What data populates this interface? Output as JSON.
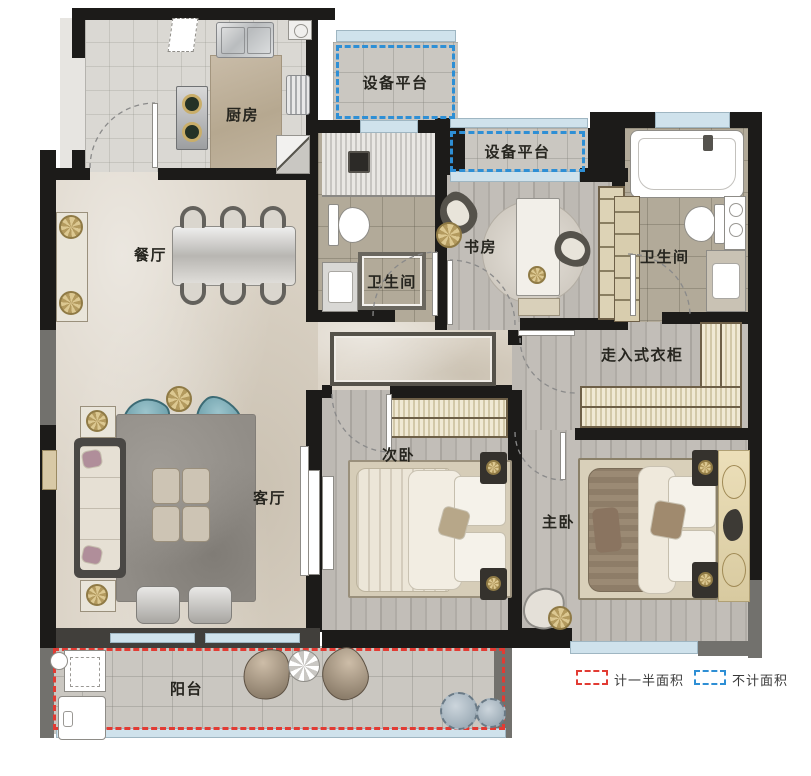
{
  "figure_type": "residential-floor-plan",
  "rooms": {
    "kitchen": {
      "label": "厨房"
    },
    "platform_top": {
      "label": "设备平台"
    },
    "platform_mid": {
      "label": "设备平台"
    },
    "dining": {
      "label": "餐厅"
    },
    "bath1": {
      "label": "卫生间"
    },
    "study": {
      "label": "书房"
    },
    "bath2": {
      "label": "卫生间"
    },
    "closet": {
      "label": "走入式衣柜"
    },
    "living": {
      "label": "客厅"
    },
    "bedroom2": {
      "label": "次卧"
    },
    "master": {
      "label": "主卧"
    },
    "balcony": {
      "label": "阳台"
    }
  },
  "legend": [
    {
      "id": "half-area",
      "label": "计一半面积",
      "swatch_color": "#e23b33",
      "swatch_style": "dashed"
    },
    {
      "id": "not-counted",
      "label": "不计面积",
      "swatch_color": "#2e8fd5",
      "swatch_style": "dashed"
    }
  ],
  "colors": {
    "wall": "#1c1b19",
    "wall_gray": "#72716d",
    "window_glass": "#cfe2ec",
    "marble_floor": "#dbd3c6",
    "wood_floor": "#b9b5af",
    "bath_floor": "#b2aa99",
    "red_dashed": "#e23b33",
    "blue_dashed": "#2e8fd5",
    "accent_teal": "#6fa8b2",
    "accent_gold": "#c8b582"
  }
}
